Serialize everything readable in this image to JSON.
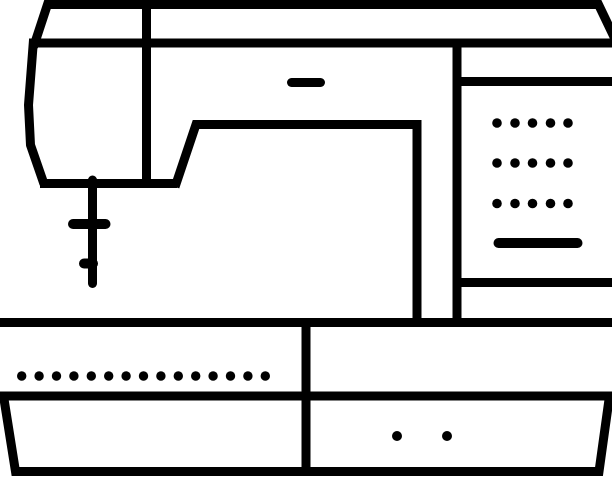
{
  "meta": {
    "title": "Sewing machine line icon",
    "background_color": "#ffffff",
    "line_color": "#000000",
    "canvas": {
      "width": 612,
      "height": 479
    }
  },
  "icon": {
    "name": "sewing-machine-icon",
    "strokes": [
      {
        "name": "top-cover-outline",
        "d": "M 33.5,47 L 47.5,4.5 L 598.5,4.5 L 616,41",
        "width": 9,
        "cap": "butt",
        "join": "miter"
      },
      {
        "name": "arm-top-line",
        "d": "M 29,43 L 612,43",
        "width": 9,
        "cap": "butt",
        "join": "miter"
      },
      {
        "name": "head-left-edge",
        "d": "M 33.5,40 L 28.5,105 L 30.5,145 L 44,184",
        "width": 9,
        "cap": "butt",
        "join": "round"
      },
      {
        "name": "head-bottom-line",
        "d": "M 40,183.5 L 177,183.5",
        "width": 9,
        "cap": "butt",
        "join": "miter"
      },
      {
        "name": "harp-cutout-outline",
        "d": "M 175,187 L 196,124.5 L 417,124.5 L 417,327",
        "width": 9,
        "cap": "butt",
        "join": "miter"
      },
      {
        "name": "head-divider-line",
        "d": "M 146.5,3 L 146.5,187",
        "width": 9,
        "cap": "butt",
        "join": "miter"
      },
      {
        "name": "needle-bar",
        "d": "M 92.5,180 L 92.5,283.5",
        "width": 9,
        "cap": "round",
        "join": "miter"
      },
      {
        "name": "presser-foot-bar",
        "d": "M 73,224 L 105.5,224",
        "width": 10,
        "cap": "round",
        "join": "miter"
      },
      {
        "name": "needle-clamp-stub",
        "d": "M 84,263.5 L 93,263.5",
        "width": 10,
        "cap": "round",
        "join": "miter"
      },
      {
        "name": "arm-dash",
        "d": "M 291.5,82.5 L 320.5,82.5",
        "width": 9,
        "cap": "round",
        "join": "miter"
      },
      {
        "name": "panel-divider-line",
        "d": "M 457,39 L 457,327",
        "width": 9,
        "cap": "butt",
        "join": "miter"
      },
      {
        "name": "panel-top-line",
        "d": "M 452.5,81.5 L 612,81.5",
        "width": 9,
        "cap": "butt",
        "join": "miter"
      },
      {
        "name": "panel-bottom-line",
        "d": "M 452.5,282.5 L 612,282.5",
        "width": 9,
        "cap": "butt",
        "join": "miter"
      },
      {
        "name": "panel-slider-dash",
        "d": "M 498.5,243 L 577.5,243",
        "width": 10,
        "cap": "round",
        "join": "miter"
      },
      {
        "name": "bed-top-line",
        "d": "M 0,322.5 L 612,322.5",
        "width": 9,
        "cap": "butt",
        "join": "miter"
      },
      {
        "name": "bed-middle-line",
        "d": "M 0,396 L 612,396",
        "width": 9,
        "cap": "butt",
        "join": "miter"
      },
      {
        "name": "bed-divider-line",
        "d": "M 306,322 L 306,476",
        "width": 9,
        "cap": "butt",
        "join": "miter"
      },
      {
        "name": "base-outline",
        "d": "M 3.5,396 L 15.5,471.5 L 599,471.5 L 609.5,396",
        "width": 9,
        "cap": "butt",
        "join": "miter"
      }
    ],
    "dot_groups": [
      {
        "name": "panel-dot-grid",
        "rows_y": [
          123,
          163,
          203.5
        ],
        "cols_x": [
          497,
          515,
          532.5,
          550.5,
          568
        ],
        "radius": 4.8
      },
      {
        "name": "bed-dot-row",
        "y": 376,
        "x_start": 21.7,
        "count": 15,
        "x_step": 17.4,
        "radius": 4.7
      },
      {
        "name": "base-dot-pair",
        "y": 436,
        "xs": [
          397,
          447
        ],
        "radius": 5
      }
    ]
  }
}
